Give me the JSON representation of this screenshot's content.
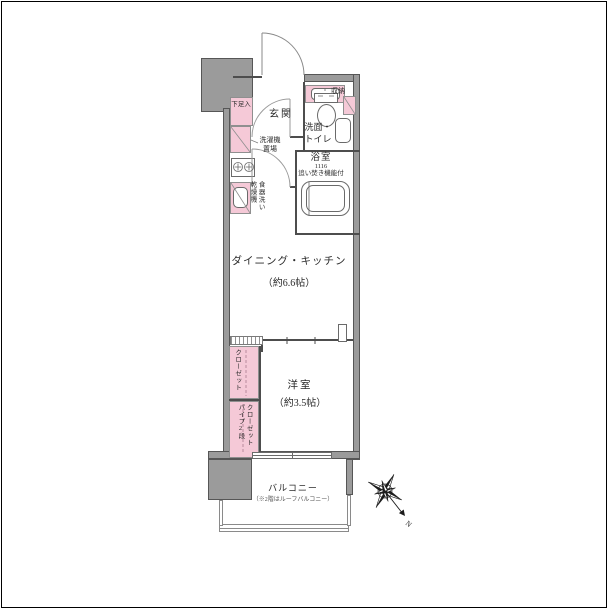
{
  "colors": {
    "wall_fill": "#9b9b9b",
    "fixture_pink": "#f5c9d7",
    "line_dark": "#4d4d4d"
  },
  "rooms": {
    "genkan": {
      "label": "玄関"
    },
    "shoe_cabinet": {
      "label": "下足入"
    },
    "storage": {
      "label": "収納"
    },
    "washroom": {
      "label_line1": "洗面・",
      "label_line2": "トイレ"
    },
    "bathroom": {
      "label": "浴室",
      "size": "1116",
      "note": "追い焚き機能付"
    },
    "laundry": {
      "label_line1": "洗濯機",
      "label_line2": "置場"
    },
    "dishwasher": {
      "label_line1": "食器洗い",
      "label_line2": "乾燥機"
    },
    "dk": {
      "label": "ダイニング・キッチン",
      "area": "（約6.6帖）"
    },
    "bedroom": {
      "label": "洋室",
      "area": "（約3.5帖）"
    },
    "closet_upper": {
      "label": "クローゼット"
    },
    "closet_lower": {
      "label_line1": "クローゼット",
      "label_line2": "パイプ2段"
    },
    "balcony": {
      "label": "バルコニー",
      "note": "（※2階はルーフバルコニー）"
    }
  },
  "compass": {
    "north_label": "N"
  }
}
